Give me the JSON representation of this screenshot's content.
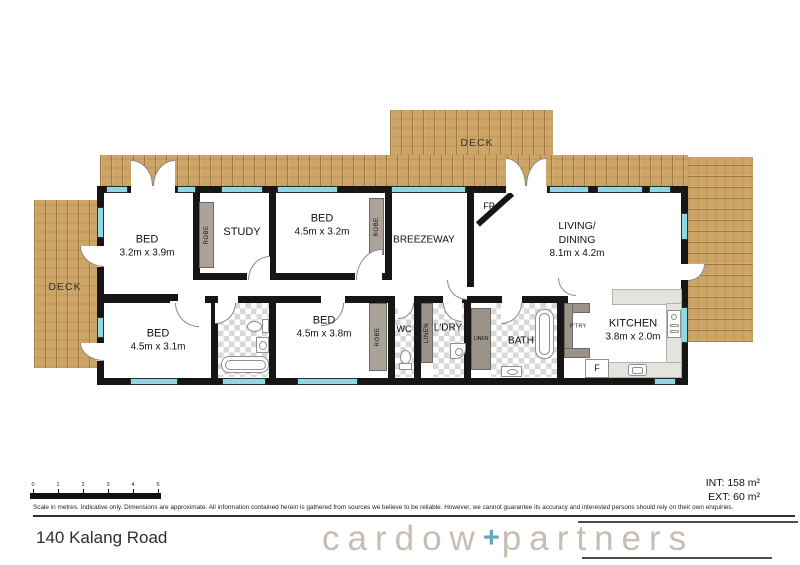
{
  "title": "140 Kalang Road",
  "areas": {
    "int": "INT: 158 m²",
    "ext": "EXT: 60 m²"
  },
  "disclaimer": "Scale in metres. Indicative only. Dimensions are approximate. All information contained herein is gathered from sources we believe to be reliable. However, we cannot guarantee its accuracy and interested persons should rely on their own enquiries.",
  "scale": {
    "ticks": [
      "0",
      "1",
      "2",
      "3",
      "4",
      "5"
    ]
  },
  "brand": {
    "left": "cardow",
    "plus": "+",
    "right": "partners"
  },
  "rooms": {
    "deck_top": "DECK",
    "deck_left": "DECK",
    "bed1": {
      "name": "BED",
      "dims": "3.2m x 3.9m"
    },
    "study": "STUDY",
    "bed2": {
      "name": "BED",
      "dims": "4.5m x 3.2m"
    },
    "breezeway": "BREEZEWAY",
    "fp": "FP",
    "living": {
      "name1": "LIVING/",
      "name2": "DINING",
      "dims": "8.1m x 4.2m"
    },
    "bed3": {
      "name": "BED",
      "dims": "4.5m x 3.1m"
    },
    "bed4": {
      "name": "BED",
      "dims": "4.5m x 3.8m"
    },
    "wc": "WC",
    "ldry": "L'DRY",
    "bath": "BATH",
    "ptry": "P'TRY",
    "kitchen": {
      "name": "KITCHEN",
      "dims": "3.8m x 2.0m"
    },
    "fridge": "F",
    "robe": "ROBE",
    "linen": "LINEN"
  },
  "colors": {
    "wall": "#161616",
    "wood": "#cda566",
    "window": "#8ed8e4",
    "robe": "#aba39a",
    "cab": "#9b9289",
    "checker": "#d8d8d8",
    "counter": "#e4e4df",
    "logo_gray": "#c9bdb2",
    "logo_teal": "#64a7b4",
    "text": "#1c1c1c"
  }
}
